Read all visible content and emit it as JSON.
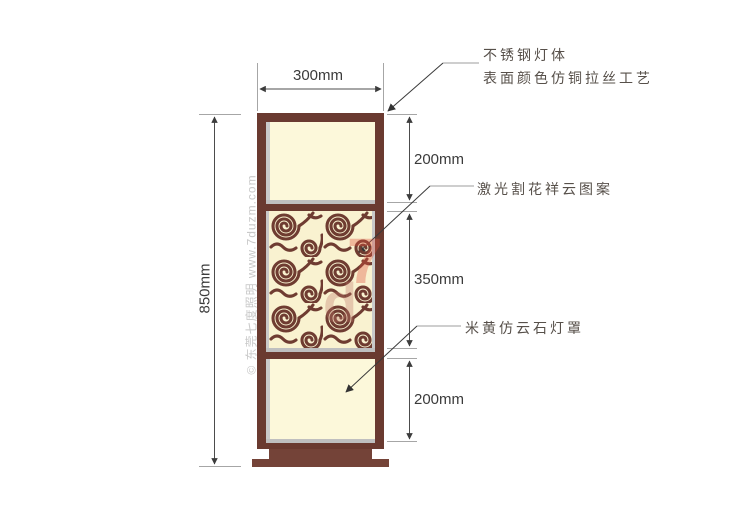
{
  "drawing": {
    "dimensions": {
      "width": "300mm",
      "total_height": "850mm",
      "top_section": "200mm",
      "middle_section": "350mm",
      "bottom_section": "200mm"
    },
    "annotations": {
      "body_line1": "不锈钢灯体",
      "body_line2": "表面颜色仿铜拉丝工艺",
      "pattern": "激光割花祥云图案",
      "shade": "米黄仿云石灯罩"
    },
    "watermark": {
      "side_text": "© 东莞七度照明  www.7duzm.com",
      "logo_top": "7",
      "logo_bottom": "d"
    },
    "colors": {
      "frame_brown": "#6a3a30",
      "base_brown": "#744338",
      "panel_cream": "#fcf8da",
      "trim_grey": "#bfbfbf",
      "pattern_stroke": "#6f3c31",
      "dimension_line": "#4c4c4c",
      "annotation_text": "#57504a",
      "watermark_grey": "#c9c9c9",
      "watermark_red": "#e15542"
    }
  }
}
